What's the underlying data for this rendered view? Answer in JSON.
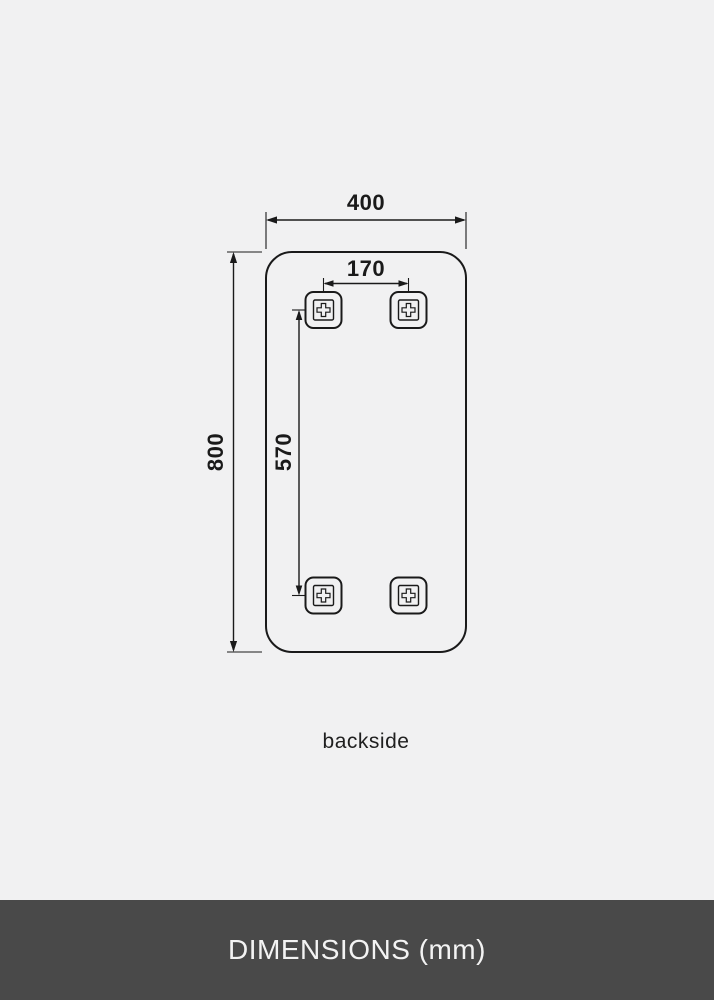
{
  "page": {
    "background_color": "#f1f1f2",
    "line_color": "#1a1a1a"
  },
  "diagram": {
    "subject": "mirror-backside-dimension-drawing",
    "caption": "backside",
    "unit": "mm",
    "dimensions": {
      "overall_width_mm": "400",
      "overall_height_mm": "800",
      "bracket_spacing_horizontal_mm": "170",
      "bracket_spacing_vertical_mm": "570"
    },
    "bracket_count": 4
  },
  "footer": {
    "title": "DIMENSIONS (mm)",
    "background_color": "#494949",
    "text_color": "#f3f3f3"
  }
}
